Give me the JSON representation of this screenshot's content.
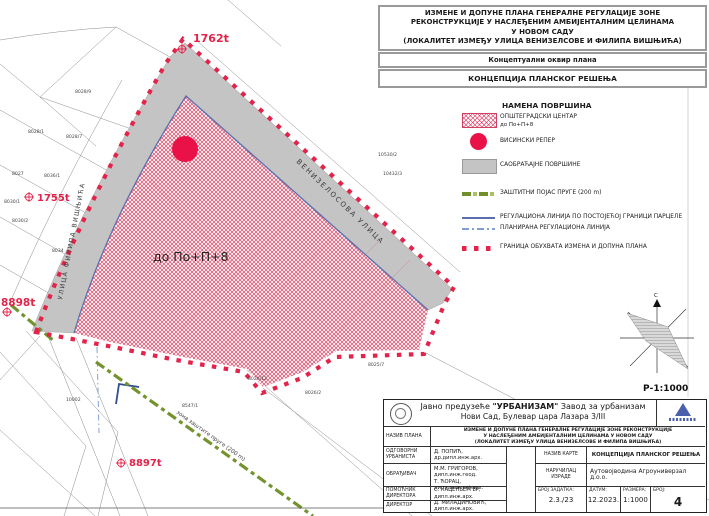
{
  "page_header": {
    "title_lines": [
      "ИЗМЕНЕ И ДОПУНЕ ПЛАНА ГЕНЕРАЛНЕ РЕГУЛАЦИЈЕ ЗОНЕ",
      "РЕКОНСТРУКЦИЈЕ У НАСЛЕЂЕНИМ АМБИЈЕНТАЛНИМ ЦЕЛИНАМА",
      "У НОВОМ САДУ",
      "(ЛОКАЛИТЕТ ИЗМЕЂУ УЛИЦА ВЕНИЗЕЛСОВЕ И ФИЛИПА ВИШЊИЋА)"
    ],
    "subtitle": "Концептуални оквир плана",
    "map_title": "КОНЦЕПЦИЈА ПЛАНСКОГ РЕШЕЊА"
  },
  "legend": {
    "title": "НАМЕНА ПОВРШИНА",
    "items": [
      {
        "symbol": "red-crosshatch-area",
        "label": "ОПШТЕГРАДСКИ ЦЕНТАР",
        "sublabel": "до По+П+8"
      },
      {
        "symbol": "red-circle",
        "label": "ВИСИНСКИ РЕПЕР"
      },
      {
        "symbol": "gray-area",
        "label": "САОБРАЋАЈНЕ ПОВРШИНЕ"
      },
      {
        "symbol": "green-dashed-line",
        "label": "ЗАШТИТНИ ПОЈАС ПРУГЕ (200 m)"
      },
      {
        "symbol": "blue-solid-line",
        "label": "РЕГУЛАЦИОНА ЛИНИЈА ПО ПОСТОЈЕЋОЈ ГРАНИЦИ ПАРЦЕЛЕ"
      },
      {
        "symbol": "blue-dashed-line",
        "label": "ПЛАНИРАНА РЕГУЛАЦИОНА ЛИНИЈА"
      },
      {
        "symbol": "red-dashed-boundary",
        "label": "ГРАНИЦА ОБУХВАТА ИЗМЕНА И ДОПУНА ПЛАНА"
      }
    ]
  },
  "map": {
    "zone_label": "до По+П+8",
    "streets": [
      "УЛИЦА ФИЛИПА ВИШЊИЋА",
      "ВЕНИЗЕЛОСОВА УЛИЦА"
    ],
    "railway_label": "зона заштите пруге (200 m)",
    "benchmarks": [
      "1762t",
      "1755t",
      "8898t",
      "8897t"
    ],
    "parcels": [
      "8028/9",
      "8028/1",
      "8028/7",
      "8027",
      "8036/1",
      "8030/1",
      "8030/2",
      "8034",
      "10002",
      "8026/12",
      "8026/2",
      "8025/7",
      "8547/1",
      "10530/2",
      "10432/3"
    ],
    "colors": {
      "zone_red": "#e3234a",
      "road_gray": "#c4c4c4",
      "rail_green": "#78982e",
      "regulation_blue": "#5b6fae",
      "planned_blue": "#7f9fd4"
    }
  },
  "north_figure": {
    "north_letter": "С",
    "scale_label": "Р-1:1000"
  },
  "title_block": {
    "company_prefix": "Јавно предузеће ",
    "company_name": "\"УРБАНИЗАМ\"",
    "company_suffix": " Завод за урбанизам",
    "company_line2": "Нови Сад, Булевар цара Лазара 3/III",
    "naziv_plana_label": "НАЗИВ ПЛАНА",
    "naziv_plana_lines": [
      "ИЗМЕНЕ И ДОПУНЕ ПЛАНА ГЕНЕРАЛНЕ РЕГУЛАЦИЈЕ ЗОНЕ  РЕКОНСТРУКЦИЈЕ",
      "У НАСЛЕЂЕНИМ АМБИЈЕНТАЛНИМ ЦЕЛИНАМА  У НОВОМ САДУ",
      "(ЛОКАЛИТЕТ ИЗМЕЂУ УЛИЦА ВЕНИЗЕЛСОВЕ И ФИЛИПА ВИШЊИЋА)"
    ],
    "odgovorni": {
      "label": "ОДГОВОРНИ УРБАНИСТА",
      "value": "Д. ПОПИЋ, др.дипл.инж.арх."
    },
    "obradjivac": {
      "label": "ОБРАЂИВАЧ",
      "value1": "М.М. ГРИГОРОВ, дипл.инж.геод.",
      "value2": "Т. ЋОРАЦ, дипл.инж.пеј.арх."
    },
    "pomocnik": {
      "label": "ПОМОЋНИК ДИРЕКТОРА",
      "value": "С. КАЦЕНБЕРГЕР, дипл.инж.арх."
    },
    "direktor": {
      "label": "ДИРЕКТОР",
      "value": "Д. МИЛАДИНОВИЋ, дипл.инж.арх."
    },
    "naziv_karte": {
      "label": "НАЗИВ КАРТЕ",
      "value": "КОНЦЕПЦИЈА ПЛАНСКОГ РЕШЕЊА"
    },
    "narucilac": {
      "label": "НАРУЧИЛАЦ ИЗРАДЕ",
      "value": "Аутовојводина Агроуниверзал д.о.о."
    },
    "broj_zadatka": {
      "label": "БРОЈ ЗАДАТКА:",
      "value": "2.3./23"
    },
    "datum": {
      "label": "ДАТУМ:",
      "value": "12.2023."
    },
    "razmera": {
      "label": "РАЗМЕРА:",
      "value": "1:1000"
    },
    "broj": {
      "label": "БРОЈ:",
      "value": "4"
    }
  }
}
